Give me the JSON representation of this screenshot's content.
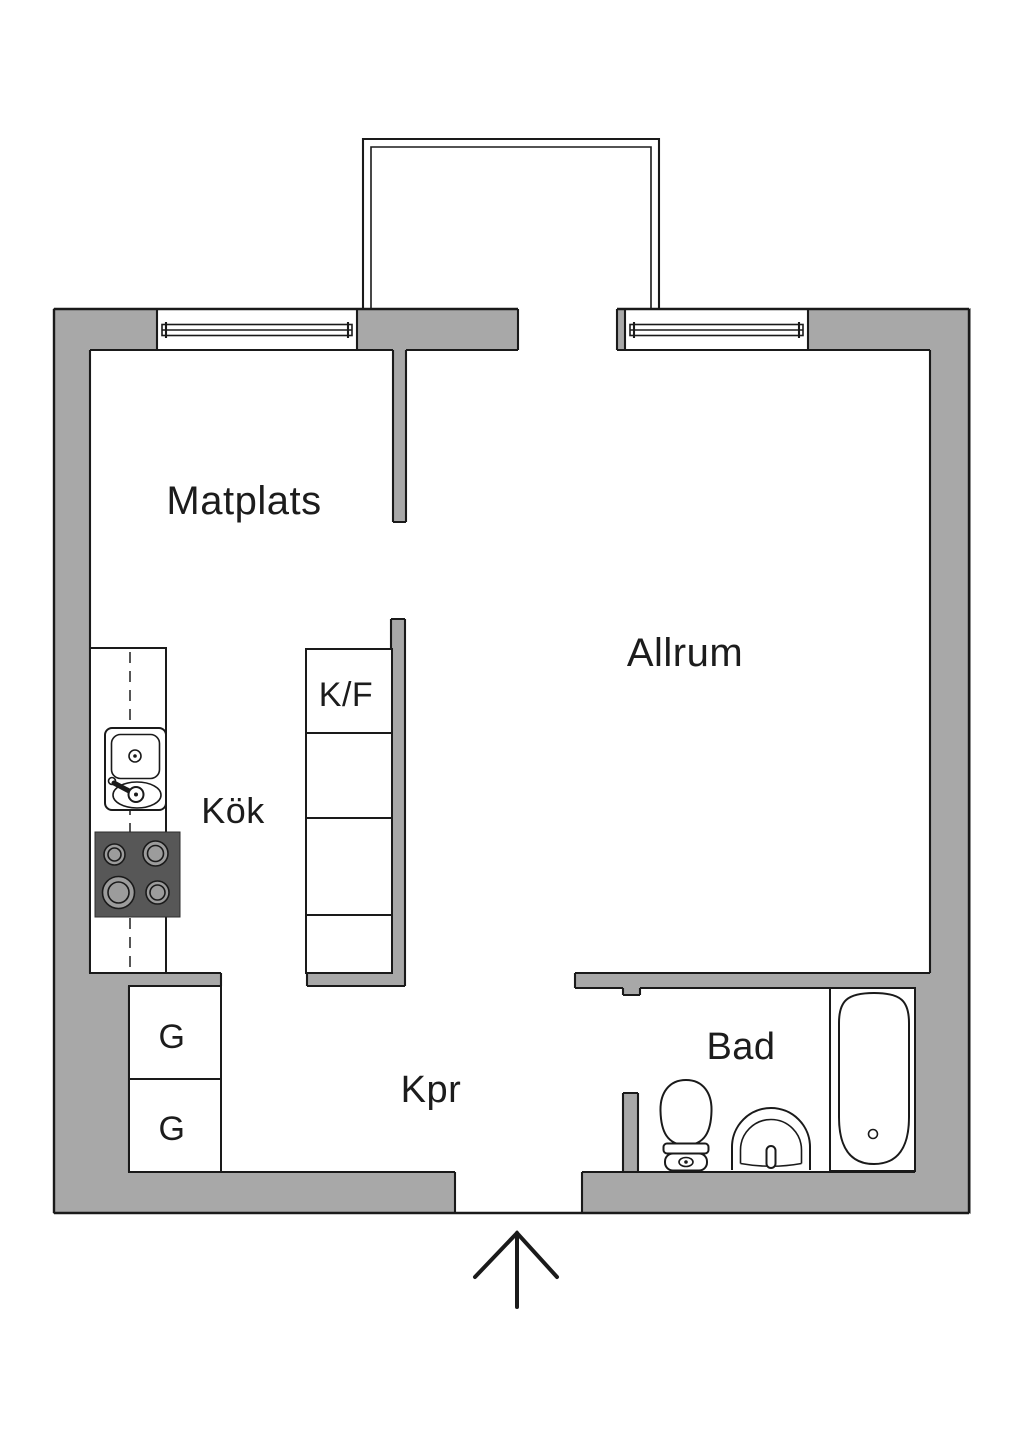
{
  "page": {
    "title": "Apartment floor plan"
  },
  "colors": {
    "wall": "#a8a8a8",
    "line": "#1a1a1a",
    "text": "#1c1c1c",
    "paper": "#ffffff",
    "stove": "#575757",
    "burner": "#9c9c9c"
  },
  "rooms": {
    "dining": {
      "label": "Matplats"
    },
    "living": {
      "label": "Allrum"
    },
    "kitchen": {
      "label": "Kök"
    },
    "hallway": {
      "label": "Kpr"
    },
    "bathroom": {
      "label": "Bad"
    }
  },
  "fixtures": {
    "fridge_freezer": {
      "label": "K/F"
    },
    "wardrobe_1": {
      "label": "G"
    },
    "wardrobe_2": {
      "label": "G"
    }
  }
}
